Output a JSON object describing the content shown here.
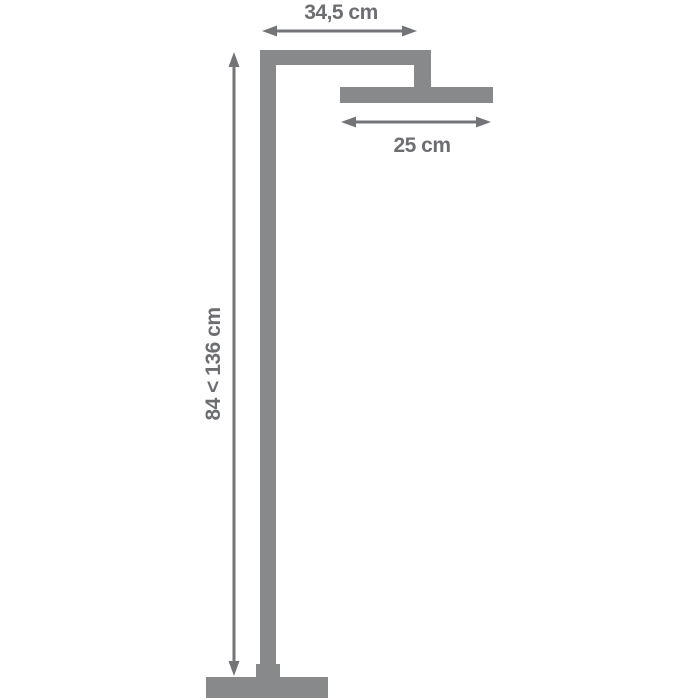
{
  "diagram": {
    "labels": {
      "top_width": "34,5 cm",
      "head_width": "25 cm",
      "height_range": "84 < 136 cm"
    },
    "colors": {
      "fixture": "#87898B",
      "dimension": "#737477",
      "label_text": "#6D6E71",
      "background": "#FFFFFF"
    }
  }
}
